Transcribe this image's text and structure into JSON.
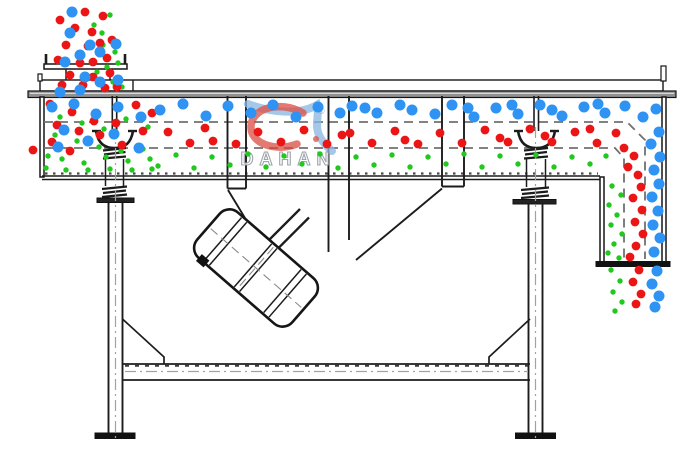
{
  "canvas": {
    "width": 700,
    "height": 470,
    "background": "#ffffff"
  },
  "watermark": {
    "brand": "DAHAN",
    "registered": "®"
  },
  "colors": {
    "line": "#1c1c1c",
    "deck_dash": "#707070",
    "blue": "#2e93f3",
    "red": "#ec1515",
    "green": "#21c81e",
    "lid_gray": "#909090",
    "logo_red": "#d8453a",
    "logo_blue": "#8ab7e3",
    "logo_text": "#949ba3"
  },
  "particles": {
    "radius": {
      "blue": 5.5,
      "red": 4.4,
      "green": 2.7
    },
    "blue": [
      [
        72,
        12
      ],
      [
        70,
        33
      ],
      [
        90,
        45
      ],
      [
        80,
        55
      ],
      [
        116,
        44
      ],
      [
        100,
        52
      ],
      [
        65,
        62
      ],
      [
        85,
        77
      ],
      [
        100,
        82
      ],
      [
        118,
        80
      ],
      [
        80,
        90
      ],
      [
        60,
        92
      ],
      [
        52,
        107
      ],
      [
        74,
        104
      ],
      [
        96,
        114
      ],
      [
        118,
        107
      ],
      [
        141,
        117
      ],
      [
        64,
        130
      ],
      [
        88,
        141
      ],
      [
        114,
        134
      ],
      [
        139,
        148
      ],
      [
        58,
        147
      ],
      [
        160,
        110
      ],
      [
        183,
        104
      ],
      [
        206,
        116
      ],
      [
        228,
        106
      ],
      [
        251,
        113
      ],
      [
        273,
        105
      ],
      [
        296,
        117
      ],
      [
        318,
        107
      ],
      [
        340,
        113
      ],
      [
        352,
        106
      ],
      [
        365,
        108
      ],
      [
        377,
        113
      ],
      [
        400,
        105
      ],
      [
        412,
        110
      ],
      [
        435,
        114
      ],
      [
        452,
        105
      ],
      [
        468,
        108
      ],
      [
        474,
        117
      ],
      [
        496,
        108
      ],
      [
        512,
        105
      ],
      [
        518,
        114
      ],
      [
        540,
        105
      ],
      [
        552,
        110
      ],
      [
        562,
        116
      ],
      [
        584,
        107
      ],
      [
        598,
        104
      ],
      [
        605,
        113
      ],
      [
        625,
        106
      ],
      [
        643,
        117
      ],
      [
        656,
        109
      ],
      [
        659,
        132
      ],
      [
        651,
        144
      ],
      [
        660,
        157
      ],
      [
        654,
        170
      ],
      [
        659,
        184
      ],
      [
        652,
        197
      ],
      [
        658,
        211
      ],
      [
        653,
        225
      ],
      [
        660,
        238
      ],
      [
        654,
        252
      ],
      [
        657,
        271
      ],
      [
        652,
        284
      ],
      [
        659,
        296
      ],
      [
        655,
        307
      ]
    ],
    "red": [
      [
        85,
        12
      ],
      [
        60,
        20
      ],
      [
        103,
        16
      ],
      [
        75,
        28
      ],
      [
        92,
        32
      ],
      [
        112,
        40
      ],
      [
        66,
        45
      ],
      [
        88,
        46
      ],
      [
        100,
        43
      ],
      [
        58,
        60
      ],
      [
        93,
        62
      ],
      [
        107,
        58
      ],
      [
        80,
        63
      ],
      [
        70,
        75
      ],
      [
        93,
        77
      ],
      [
        110,
        73
      ],
      [
        83,
        85
      ],
      [
        105,
        88
      ],
      [
        62,
        85
      ],
      [
        117,
        87
      ],
      [
        50,
        104
      ],
      [
        72,
        112
      ],
      [
        94,
        121
      ],
      [
        116,
        123
      ],
      [
        136,
        105
      ],
      [
        152,
        113
      ],
      [
        57,
        125
      ],
      [
        79,
        131
      ],
      [
        100,
        135
      ],
      [
        122,
        145
      ],
      [
        143,
        131
      ],
      [
        52,
        142
      ],
      [
        70,
        151
      ],
      [
        33,
        150
      ],
      [
        168,
        132
      ],
      [
        190,
        143
      ],
      [
        205,
        128
      ],
      [
        213,
        141
      ],
      [
        236,
        144
      ],
      [
        258,
        132
      ],
      [
        281,
        142
      ],
      [
        304,
        130
      ],
      [
        327,
        144
      ],
      [
        342,
        135
      ],
      [
        350,
        133
      ],
      [
        372,
        143
      ],
      [
        395,
        131
      ],
      [
        405,
        140
      ],
      [
        418,
        144
      ],
      [
        440,
        133
      ],
      [
        462,
        143
      ],
      [
        485,
        130
      ],
      [
        500,
        138
      ],
      [
        508,
        142
      ],
      [
        530,
        129
      ],
      [
        545,
        136
      ],
      [
        552,
        142
      ],
      [
        575,
        132
      ],
      [
        590,
        129
      ],
      [
        597,
        143
      ],
      [
        616,
        133
      ],
      [
        624,
        148
      ],
      [
        634,
        156
      ],
      [
        628,
        167
      ],
      [
        638,
        175
      ],
      [
        641,
        187
      ],
      [
        633,
        198
      ],
      [
        642,
        210
      ],
      [
        635,
        222
      ],
      [
        643,
        234
      ],
      [
        636,
        246
      ],
      [
        630,
        257
      ],
      [
        639,
        270
      ],
      [
        633,
        282
      ],
      [
        641,
        294
      ],
      [
        636,
        304
      ]
    ],
    "green": [
      [
        102,
        33
      ],
      [
        94,
        25
      ],
      [
        110,
        15
      ],
      [
        103,
        45
      ],
      [
        115,
        52
      ],
      [
        107,
        67
      ],
      [
        118,
        63
      ],
      [
        97,
        72
      ],
      [
        113,
        82
      ],
      [
        122,
        87
      ],
      [
        60,
        117
      ],
      [
        82,
        123
      ],
      [
        104,
        129
      ],
      [
        126,
        119
      ],
      [
        148,
        127
      ],
      [
        55,
        135
      ],
      [
        77,
        141
      ],
      [
        99,
        147
      ],
      [
        121,
        151
      ],
      [
        143,
        149
      ],
      [
        48,
        156
      ],
      [
        62,
        159
      ],
      [
        84,
        163
      ],
      [
        106,
        157
      ],
      [
        128,
        161
      ],
      [
        150,
        159
      ],
      [
        46,
        168
      ],
      [
        66,
        170
      ],
      [
        88,
        170
      ],
      [
        110,
        169
      ],
      [
        132,
        170
      ],
      [
        152,
        169
      ],
      [
        158,
        166
      ],
      [
        176,
        155
      ],
      [
        194,
        168
      ],
      [
        212,
        157
      ],
      [
        230,
        165
      ],
      [
        248,
        154
      ],
      [
        266,
        167
      ],
      [
        284,
        156
      ],
      [
        302,
        164
      ],
      [
        320,
        154
      ],
      [
        338,
        168
      ],
      [
        356,
        157
      ],
      [
        374,
        165
      ],
      [
        392,
        155
      ],
      [
        410,
        167
      ],
      [
        428,
        157
      ],
      [
        446,
        164
      ],
      [
        464,
        154
      ],
      [
        482,
        167
      ],
      [
        500,
        156
      ],
      [
        518,
        164
      ],
      [
        536,
        155
      ],
      [
        554,
        167
      ],
      [
        572,
        157
      ],
      [
        590,
        164
      ],
      [
        606,
        156
      ],
      [
        612,
        186
      ],
      [
        621,
        195
      ],
      [
        609,
        205
      ],
      [
        617,
        215
      ],
      [
        611,
        225
      ],
      [
        622,
        234
      ],
      [
        614,
        244
      ],
      [
        608,
        253
      ],
      [
        619,
        258
      ],
      [
        611,
        270
      ],
      [
        620,
        281
      ],
      [
        613,
        292
      ],
      [
        622,
        302
      ],
      [
        615,
        311
      ]
    ]
  }
}
